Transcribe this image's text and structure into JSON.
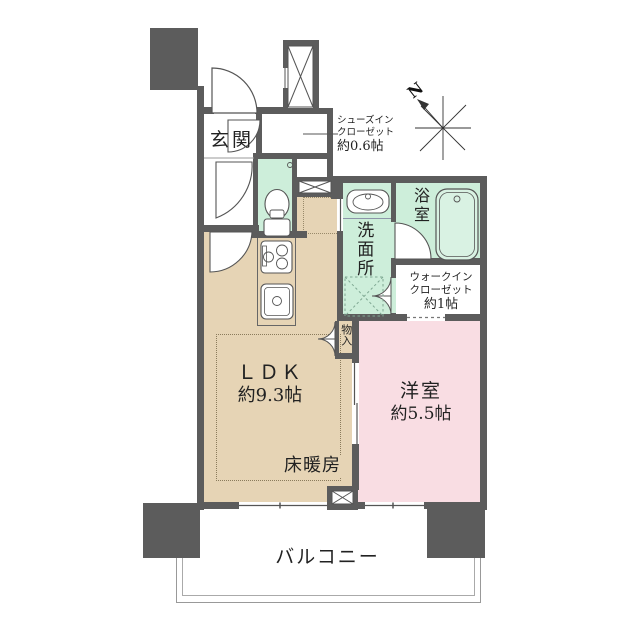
{
  "title": "apartment-floor-plan",
  "compass": {
    "n": "N"
  },
  "labels": {
    "genkan": "玄関",
    "sic1": "シューズイン",
    "sic2": "クローゼット",
    "sic3": "約0.6帖",
    "bathroom": "浴室",
    "washroom": "洗面所",
    "wic1": "ウォークイン",
    "wic2": "クローゼット",
    "wic3": "約1帖",
    "ldk1": "ＬＤＫ",
    "ldk2": "約9.3帖",
    "floor_heating": "床暖房",
    "western1": "洋室",
    "western2": "約5.5帖",
    "storage": "物入",
    "balcony": "バルコニー"
  },
  "colors": {
    "wall": "#5c5c5c",
    "ldk_floor": "#e6d4b5",
    "western_room_floor": "#f9dde3",
    "wet_area": "#cdeeda",
    "text": "#222222",
    "balcony_line": "#999999"
  }
}
